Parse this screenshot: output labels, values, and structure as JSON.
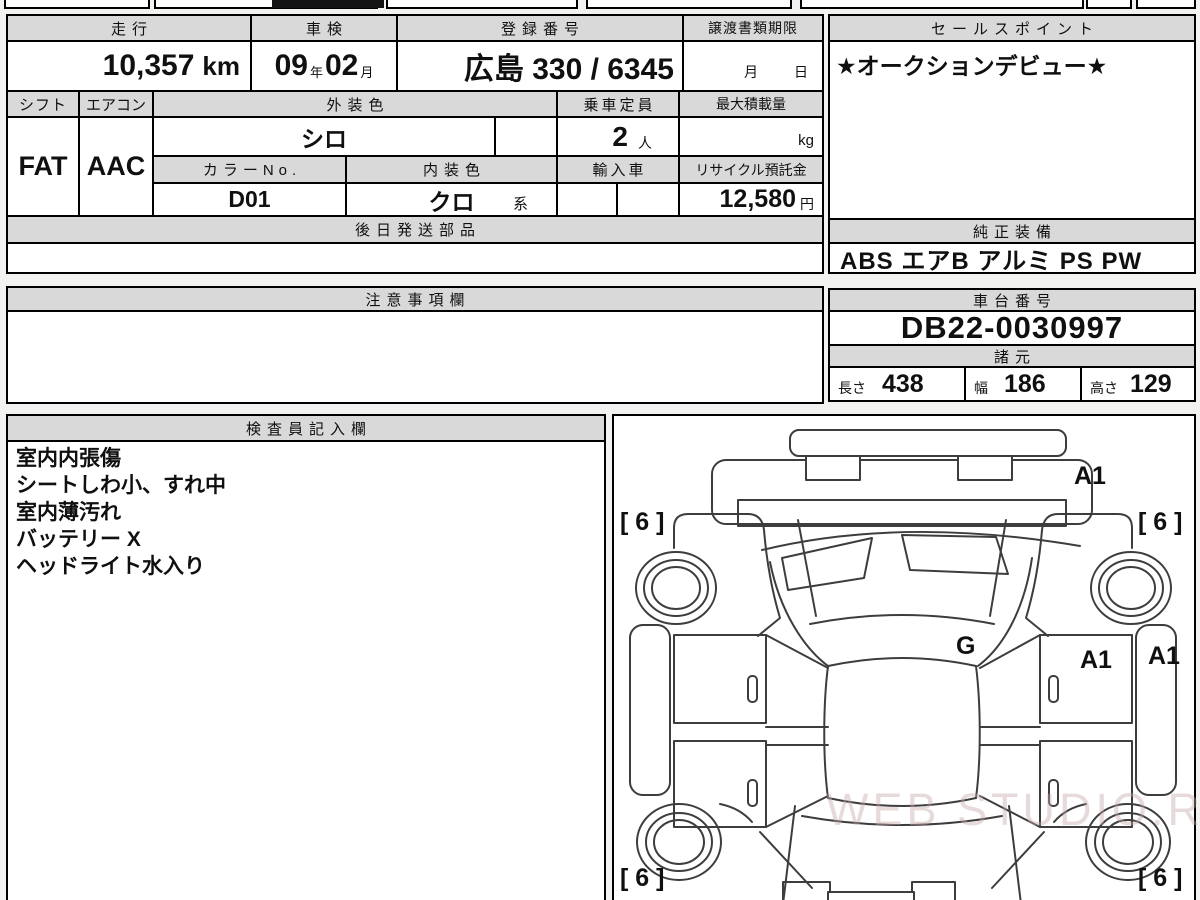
{
  "watermark": "WEB STUDIO.RU",
  "table": {
    "odometer": {
      "label": "走行",
      "value": "10,357",
      "unit": "km"
    },
    "inspection": {
      "label": "車検",
      "year": "09",
      "year_suffix": "年",
      "month": "02",
      "month_suffix": "月"
    },
    "registration": {
      "label": "登録番号",
      "value": "広島 330 / 6345"
    },
    "transfer_docs": {
      "label": "譲渡書類期限",
      "month_suffix": "月",
      "day_suffix": "日"
    },
    "sales_point": {
      "label": "セールスポイント",
      "value": "★オークションデビュー★"
    },
    "shift": {
      "label": "シフト",
      "value": "FAT"
    },
    "aircon": {
      "label": "エアコン",
      "value": "AAC"
    },
    "exterior_color": {
      "label": "外装色",
      "value": "シロ"
    },
    "capacity": {
      "label": "乗車定員",
      "value": "2",
      "unit": "人"
    },
    "max_load": {
      "label": "最大積載量",
      "value": "",
      "unit": "kg"
    },
    "color_no": {
      "label": "カラーNo.",
      "value": "D01"
    },
    "interior_color": {
      "label": "内装色",
      "value": "クロ",
      "suffix": "系"
    },
    "imported": {
      "label": "輸入車",
      "value": ""
    },
    "recycle_deposit": {
      "label": "リサイクル預託金",
      "value": "12,580",
      "unit": "円"
    },
    "later_shipped_parts": {
      "label": "後日発送部品",
      "value": ""
    },
    "genuine_equipment": {
      "label": "純正装備",
      "value": "ABS エアB アルミ PS PW"
    },
    "notice": {
      "label": "注意事項欄",
      "value": ""
    },
    "chassis_no": {
      "label": "車台番号",
      "value": "DB22-0030997"
    },
    "dimensions": {
      "label": "諸元",
      "length_label": "長さ",
      "length": "438",
      "width_label": "幅",
      "width": "186",
      "height_label": "高さ",
      "height": "129"
    },
    "inspector_notes": {
      "label": "検査員記入欄",
      "lines": [
        "室内内張傷",
        "シートしわ小、すれ中",
        "室内薄汚れ",
        "バッテリー X",
        "ヘッドライト水入り"
      ]
    }
  },
  "diagram": {
    "marks": {
      "a1_top": "A1",
      "six_top_left": "[ 6 ]",
      "six_top_right": "[ 6 ]",
      "g_center": "G",
      "a1_mid": "A1",
      "a1_right": "A1",
      "six_bottom_left": "[ 6 ]",
      "six_bottom_right": "[ 6 ]"
    }
  },
  "colors": {
    "header_bg": "#d9d9d9",
    "border": "#000000",
    "watermark_tint": "#c6a6a6"
  }
}
